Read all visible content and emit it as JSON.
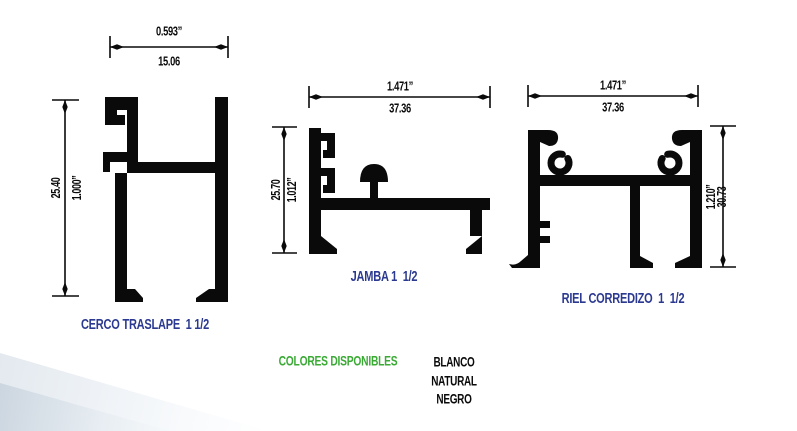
{
  "page": {
    "width": 797,
    "height": 431,
    "background": "#ffffff"
  },
  "colors": {
    "drawing_black": "#0a0a0a",
    "label_blue": "#2b3990",
    "accent_green": "#3aaa35",
    "corner_shade": "#ccd6e0"
  },
  "profiles": [
    {
      "name": "cerco-traslape",
      "label": "CERCO TRASLAPE  1 1/2",
      "width_dim": {
        "inches": "0.593”",
        "mm": "15.06"
      },
      "height_dim": {
        "mm": "25.40",
        "inches": "1.000”"
      }
    },
    {
      "name": "jamba",
      "label": "JAMBA 1  1/2",
      "width_dim": {
        "inches": "1.471”",
        "mm": "37.36"
      },
      "height_dim": {
        "mm": "25.70",
        "inches": "1.012”"
      }
    },
    {
      "name": "riel-corredizo",
      "label": "RIEL CORREDIZO  1  1/2",
      "width_dim": {
        "inches": "1.471”",
        "mm": "37.36"
      },
      "height_dim": {
        "inches": "1.210”",
        "mm": "30.73"
      }
    }
  ],
  "colors_available": {
    "title": "COLORES DISPONIBLES",
    "options": [
      "BLANCO",
      "NATURAL",
      "NEGRO"
    ]
  }
}
